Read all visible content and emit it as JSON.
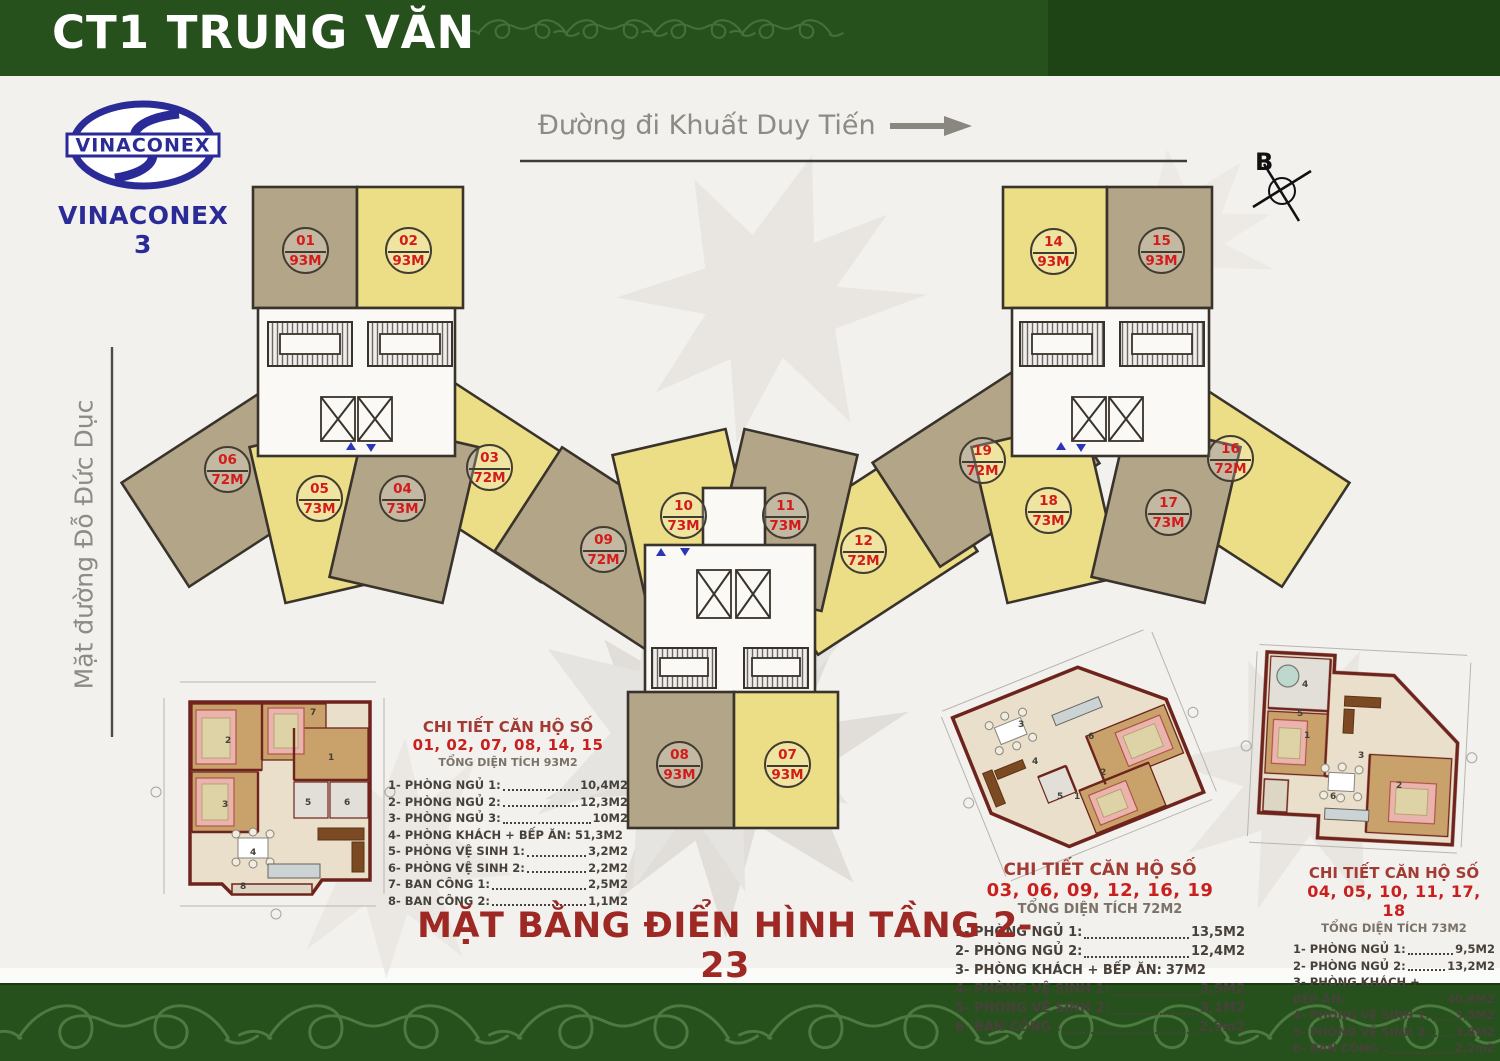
{
  "header": {
    "title": "CT1 TRUNG VĂN"
  },
  "logo": {
    "name": "VINACONEX",
    "subtitle": "VINACONEX 3"
  },
  "streets": {
    "top": {
      "label": "Đường đi Khuất Duy Tiến"
    },
    "left": {
      "label": "Mặt đường Đỗ Đức Dục"
    }
  },
  "compass": {
    "label": "B"
  },
  "footer": {
    "title": "MẶT BẰNG ĐIỂN HÌNH TẦNG 2-23"
  },
  "colors": {
    "banner_green": "#27511c",
    "unit_tan": "#b3a688",
    "unit_yellow": "#ecdd87",
    "badge_red": "#d31b1b",
    "title_red": "#9e2823",
    "logo_blue": "#2b2b98"
  },
  "units": [
    {
      "id": "01",
      "area": "93M",
      "x": 282,
      "y": 227
    },
    {
      "id": "02",
      "area": "93M",
      "x": 385,
      "y": 227
    },
    {
      "id": "03",
      "area": "72M",
      "x": 466,
      "y": 444
    },
    {
      "id": "04",
      "area": "73M",
      "x": 379,
      "y": 475
    },
    {
      "id": "05",
      "area": "73M",
      "x": 296,
      "y": 475
    },
    {
      "id": "06",
      "area": "72M",
      "x": 204,
      "y": 446
    },
    {
      "id": "07",
      "area": "93M",
      "x": 764,
      "y": 741
    },
    {
      "id": "08",
      "area": "93M",
      "x": 656,
      "y": 741
    },
    {
      "id": "09",
      "area": "72M",
      "x": 580,
      "y": 526
    },
    {
      "id": "10",
      "area": "73M",
      "x": 660,
      "y": 492
    },
    {
      "id": "11",
      "area": "73M",
      "x": 762,
      "y": 492
    },
    {
      "id": "12",
      "area": "72M",
      "x": 840,
      "y": 527
    },
    {
      "id": "14",
      "area": "93M",
      "x": 1030,
      "y": 228
    },
    {
      "id": "15",
      "area": "93M",
      "x": 1138,
      "y": 227
    },
    {
      "id": "16",
      "area": "72M",
      "x": 1207,
      "y": 435
    },
    {
      "id": "17",
      "area": "73M",
      "x": 1145,
      "y": 489
    },
    {
      "id": "18",
      "area": "73M",
      "x": 1025,
      "y": 487
    },
    {
      "id": "19",
      "area": "72M",
      "x": 959,
      "y": 437
    }
  ],
  "legends": [
    {
      "title": "CHI TIẾT CĂN HỘ SỐ",
      "units_line": "01, 02, 07, 08, 14, 15",
      "subtitle": "TỔNG DIỆN TÍCH 93M2",
      "items": [
        {
          "label": "1- PHÒNG NGỦ 1:",
          "value": "10,4M2"
        },
        {
          "label": "2- PHÒNG NGỦ 2:",
          "value": "12,3M2"
        },
        {
          "label": "3- PHÒNG NGỦ 3:",
          "value": "10M2"
        },
        {
          "label": "4- PHÒNG KHÁCH + BẾP ĂN:",
          "value": "51,3M2",
          "cls": "noleader"
        },
        {
          "label": "5- PHÒNG VỆ SINH 1:",
          "value": "3,2M2"
        },
        {
          "label": "6- PHÒNG VỆ SINH 2:",
          "value": "2,2M2"
        },
        {
          "label": "7- BAN CÔNG 1:",
          "value": "2,5M2"
        },
        {
          "label": "8- BAN CÔNG 2:",
          "value": "1,1M2"
        }
      ]
    },
    {
      "title": "CHI TIẾT CĂN HỘ SỐ",
      "units_line": "03, 06, 09, 12, 16, 19",
      "subtitle": "TỔNG DIỆN TÍCH 72M2",
      "items": [
        {
          "label": "1- PHÒNG NGỦ 1:",
          "value": "13,5M2"
        },
        {
          "label": "2- PHÒNG NGỦ 2:",
          "value": "12,4M2"
        },
        {
          "label": "3- PHÒNG KHÁCH + BẾP ĂN:",
          "value": "37M2",
          "cls": "noleader"
        },
        {
          "label": "4- PHÒNG VỆ SINH 1:",
          "value": "3,5M2"
        },
        {
          "label": "5- PHÒNG VỆ SINH 2:",
          "value": "3,1M2"
        },
        {
          "label": "6- BAN CÔNG :",
          "value": "2,5m2"
        }
      ]
    },
    {
      "title": "CHI TIẾT CĂN HỘ SỐ",
      "units_line": "04, 05, 10, 11, 17, 18",
      "subtitle": "TỔNG DIỆN TÍCH 73M2",
      "items": [
        {
          "label": "1- PHÒNG NGỦ 1:",
          "value": "9,5M2"
        },
        {
          "label": "2- PHÒNG NGỦ 2:",
          "value": "13,2M2"
        },
        {
          "label": "3- PHÒNG KHÁCH + BẾP ĂN:",
          "value": "40,8M2",
          "cls": "noleader"
        },
        {
          "label": "4- PHÒNG VỆ SINH 1:",
          "value": "3,5M2"
        },
        {
          "label": "5- PHÒNG VỆ SINH 2:",
          "value": "3,8M2"
        },
        {
          "label": "6- BAN CÔNG :",
          "value": "2,2m2"
        }
      ]
    }
  ],
  "detail_room_labels": [
    {
      "n": "2",
      "x": 225,
      "y": 736
    },
    {
      "n": "7",
      "x": 310,
      "y": 708
    },
    {
      "n": "1",
      "x": 328,
      "y": 753
    },
    {
      "n": "3",
      "x": 222,
      "y": 800
    },
    {
      "n": "5",
      "x": 305,
      "y": 798
    },
    {
      "n": "6",
      "x": 344,
      "y": 798
    },
    {
      "n": "4",
      "x": 250,
      "y": 848
    },
    {
      "n": "8",
      "x": 240,
      "y": 882
    },
    {
      "n": "3",
      "x": 1018,
      "y": 720
    },
    {
      "n": "6",
      "x": 1088,
      "y": 732
    },
    {
      "n": "4",
      "x": 1032,
      "y": 757
    },
    {
      "n": "2",
      "x": 1100,
      "y": 768
    },
    {
      "n": "5",
      "x": 1057,
      "y": 792
    },
    {
      "n": "1",
      "x": 1074,
      "y": 792
    },
    {
      "n": "4",
      "x": 1302,
      "y": 680
    },
    {
      "n": "5",
      "x": 1297,
      "y": 709
    },
    {
      "n": "1",
      "x": 1304,
      "y": 731
    },
    {
      "n": "3",
      "x": 1358,
      "y": 751
    },
    {
      "n": "2",
      "x": 1396,
      "y": 781
    },
    {
      "n": "6",
      "x": 1330,
      "y": 792
    }
  ]
}
